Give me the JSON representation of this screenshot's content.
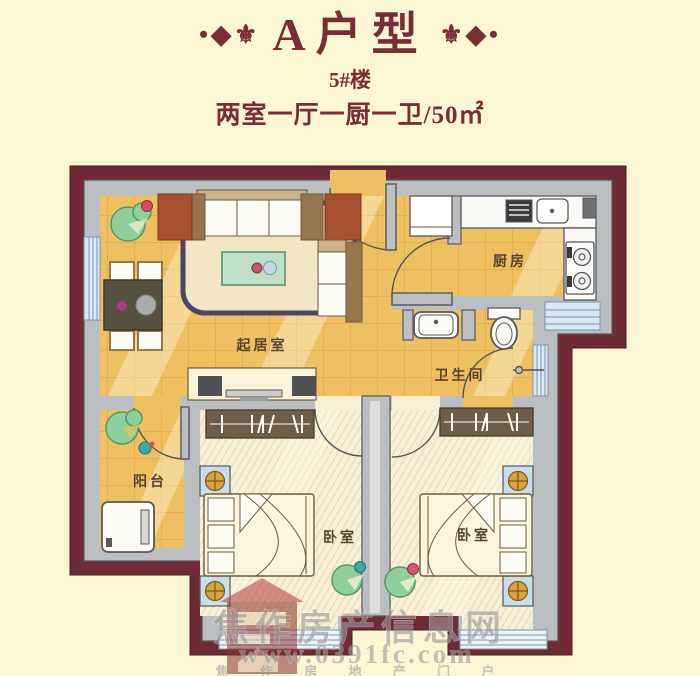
{
  "title": {
    "ornament_left": "•◆⚜",
    "ornament_right": "⚜◆•",
    "name": "A户型",
    "building": "5#楼",
    "spec": "两室一厅一厨一卫/50㎡"
  },
  "rooms": {
    "living_room": "起居室",
    "kitchen": "厨房",
    "bathroom": "卫生间",
    "balcony": "阳台",
    "bedroom_left": "卧室",
    "bedroom_right": "卧室"
  },
  "watermark": {
    "site_name": "焦作房产信息网",
    "site_url": "www.0391fc.com",
    "tagline": "焦 作 房 地 产 门 户"
  },
  "colors": {
    "page_background": "#FBF7D2",
    "title_text": "#7B2D36",
    "outer_wall": "#6E2B35",
    "inner_wall": "#BCBFC1",
    "floor_gold": "#EFC061",
    "floor_tile_line": "#D8A040",
    "bedroom_floor": "#F8EFD8",
    "window_blue": "#D9E9F4",
    "rug_border": "#4A4663",
    "sofa_frame": "#97764E",
    "side_table_brick": "#A8502F",
    "coffee_table_green": "#BFE0C6",
    "wardrobe_brown": "#6F5D4B",
    "nightstand_blue": "#C9DEEC",
    "lamp_gold": "#D9A43C",
    "plant_green": "#8FCF9B",
    "watermark_gray": "#9A9A9A"
  }
}
